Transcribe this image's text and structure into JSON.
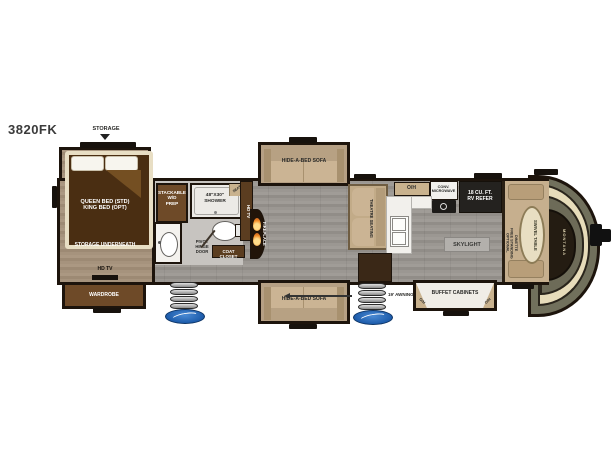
{
  "plan": {
    "model": "3820FK"
  },
  "colors": {
    "wall": "#1d140c",
    "floor_gray": "#98948f",
    "floor_tan": "#a3907a",
    "cabinet_brown": "#6e4a28",
    "bed_brown": "#4a2e12",
    "cream": "#e8dec4",
    "sofa_tan": "#c9b292",
    "counter_white": "#f1efeb",
    "refer_black": "#24221f",
    "cap_olive": "#71705c",
    "logo_blue": "#2563ae",
    "flame_orange": "#f08c28"
  },
  "bedroom": {
    "storage": "STORAGE",
    "bed": "QUEEN BED (STD)\nKING BED (OPT)",
    "storage_underneath": "STORAGE UNDERNEATH",
    "hd_tv": "HD TV",
    "wardrobe": "WARDROBE"
  },
  "bath": {
    "wd_prep": "STACKABLE\nW/D\nPREP",
    "shower": "48\"X30\"\nSHOWER",
    "seat": "SEAT",
    "pivot": "PIVOT\nHINGE\nDOOR",
    "coat_closet": "COAT CLOSET"
  },
  "living": {
    "hd_tv": "HD TV",
    "fireplace": "FIREPLACE",
    "sofa_top": "HIDE-A-BED SOFA",
    "sofa_bottom": "HIDE-A-BED SOFA",
    "theatre": "THEATRE SEATING"
  },
  "kitchen": {
    "oh": "O/H",
    "microwave": "CONV.\nMICROWAVE",
    "refer": "18 CU. FT.\nRV REFER",
    "skylight": "SKYLIGHT"
  },
  "exterior": {
    "awning": "19' AWNING",
    "buffet": "BUFFET CABINETS",
    "buffet_oh_left": "O/H",
    "buffet_oh_right": "O/H"
  },
  "dinette": {
    "optional": "OPTIONAL\nFREE STANDING\nDINETTE",
    "swivel": "SWIVEL TABLE"
  },
  "brand": {
    "front_cap": "MONTANA"
  }
}
